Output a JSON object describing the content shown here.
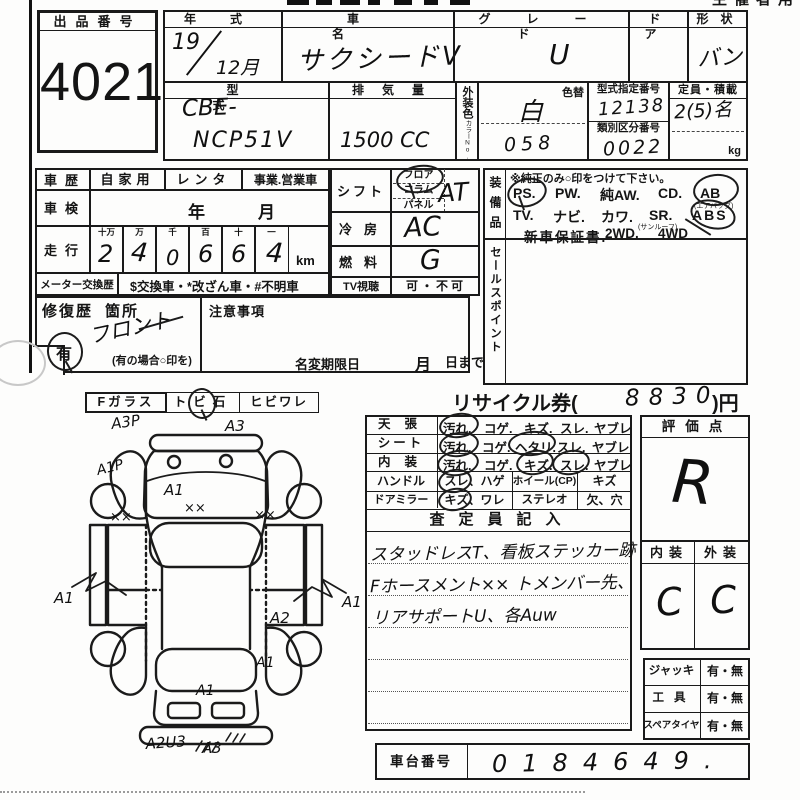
{
  "header": {
    "right_fragment": "主催者用"
  },
  "exhibit": {
    "label": "出品番号",
    "number": "4021"
  },
  "top": {
    "year_label": "年式",
    "year": "19",
    "month": "12月",
    "name_label": "車名",
    "name": "サクシードV",
    "grade_label": "グレード",
    "grade": "U",
    "door_label": "ドア",
    "shape_label": "形状",
    "shape": "バン",
    "model_label": "型式",
    "model1": "CBE-",
    "model2": "NCP51V",
    "disp_label": "排気量",
    "disp": "1500 CC",
    "color_label": "外装色",
    "color_no_label": "カラーNo.",
    "color_change_label": "色替",
    "color": "白",
    "color_code": "058",
    "type_no_label": "型式指定番号",
    "type_no": "12138",
    "class_no_label": "類別区分番号",
    "class_no": "0022",
    "cap_label": "定員・積載",
    "cap": "2(5)名",
    "cap_unit": "kg"
  },
  "history": {
    "label": "車歴",
    "opt1": "自家用",
    "opt2": "レンタ",
    "opt3": "事業.営業車",
    "inspection_label": "車検",
    "inspection_year": "年",
    "inspection_month": "月",
    "mileage_label": "走行",
    "digit_headers": [
      "十万",
      "万",
      "千",
      "百",
      "十",
      "一"
    ],
    "digits": [
      "2",
      "4",
      "0",
      "6",
      "6",
      "4"
    ],
    "unit": "km",
    "meter_label": "メーター交換歴",
    "meter_value": "$交換車・*改ざん車・#不明車"
  },
  "drivetrain": {
    "shift_label": "シフト",
    "shift_opts": [
      "フロア",
      "コラム",
      "パネル"
    ],
    "shift_value": "AT",
    "ac_label": "冷房",
    "ac_value": "AC",
    "fuel_label": "燃料",
    "fuel_value": "G",
    "tv_label": "TV視聴",
    "tv_value": "可・不可"
  },
  "equipment": {
    "label": "装備品",
    "note": "※純正のみ○印をつけて下さい。",
    "line1": [
      "PS.",
      "PW.",
      "純AW.",
      "CD.",
      "AB"
    ],
    "line1_sub": "(エアバッグ)",
    "line2": [
      "TV.",
      "ナビ.",
      "カワ.",
      "SR.",
      "ABS"
    ],
    "line2_sub": "(サンルーフ)",
    "line3": [
      "新車保証書.",
      "2WD.",
      "4WD"
    ]
  },
  "sales_point_label": "セールスポイント",
  "repair": {
    "label": "修復歴",
    "label2": "箇所",
    "value": "フロント",
    "mark": "有",
    "note": "(有の場合○印を)"
  },
  "caution": {
    "label": "注意事項",
    "rename_label": "名変期限日",
    "month": "月",
    "day": "日まで"
  },
  "glass": {
    "label": "Fガラス",
    "opt1": "トビ石",
    "opt2": "ヒビワレ"
  },
  "recycle": {
    "prefix": "リサイクル券(",
    "amount": "8830",
    "suffix": ")円"
  },
  "condition": {
    "rows": [
      {
        "label": "天張",
        "opts": [
          "汚れ.",
          "コゲ.",
          "キズ.",
          "スレ.",
          "ヤブレ"
        ]
      },
      {
        "label": "シート",
        "opts": [
          "汚れ.",
          "コゲ.",
          "ヘタリ.",
          "スレ.",
          "ヤブレ"
        ]
      },
      {
        "label": "内装",
        "opts": [
          "汚れ.",
          "コゲ.",
          "キズ.",
          "スレ.",
          "ヤブレ"
        ]
      }
    ],
    "handle": {
      "label": "ハンドル",
      "opt": "スレ、ハゲ",
      "wheel_label": "ホイール(CP)",
      "wheel_opt": "キズ"
    },
    "mirror": {
      "label": "ドアミラー",
      "opt": "キズ、ワレ",
      "stereo_label": "ステレオ",
      "stereo_opt": "欠、穴"
    }
  },
  "inspector": {
    "header": "査定員記入",
    "notes": [
      "スタッドレスT、看板ステッカー跡",
      "Fホースメント×× トメンバー先、",
      "リアサポートU、各Auw"
    ]
  },
  "evaluation": {
    "header": "評価点",
    "score": "R",
    "int_label": "内装",
    "ext_label": "外装",
    "int_score": "C",
    "ext_score": "C"
  },
  "accessories": [
    {
      "label": "ジャッキ",
      "value": "有・無"
    },
    {
      "label": "工具",
      "value": "有・無"
    },
    {
      "label": "スペアタイヤ",
      "value": "有・無"
    }
  ],
  "chassis": {
    "label": "車台番号",
    "value": "0184649."
  },
  "diagram": {
    "a3p": "A3P",
    "a3_top": "A3",
    "a1p": "A1P",
    "a1_hood": "A1",
    "xx": "××",
    "a1_left": "A1",
    "a1_right": "A1",
    "a2_right": "A2",
    "a1_rear_side": "A1",
    "a1_tailgate": "A1",
    "a2u3": "A2U3",
    "a3_bottom": "A3"
  }
}
